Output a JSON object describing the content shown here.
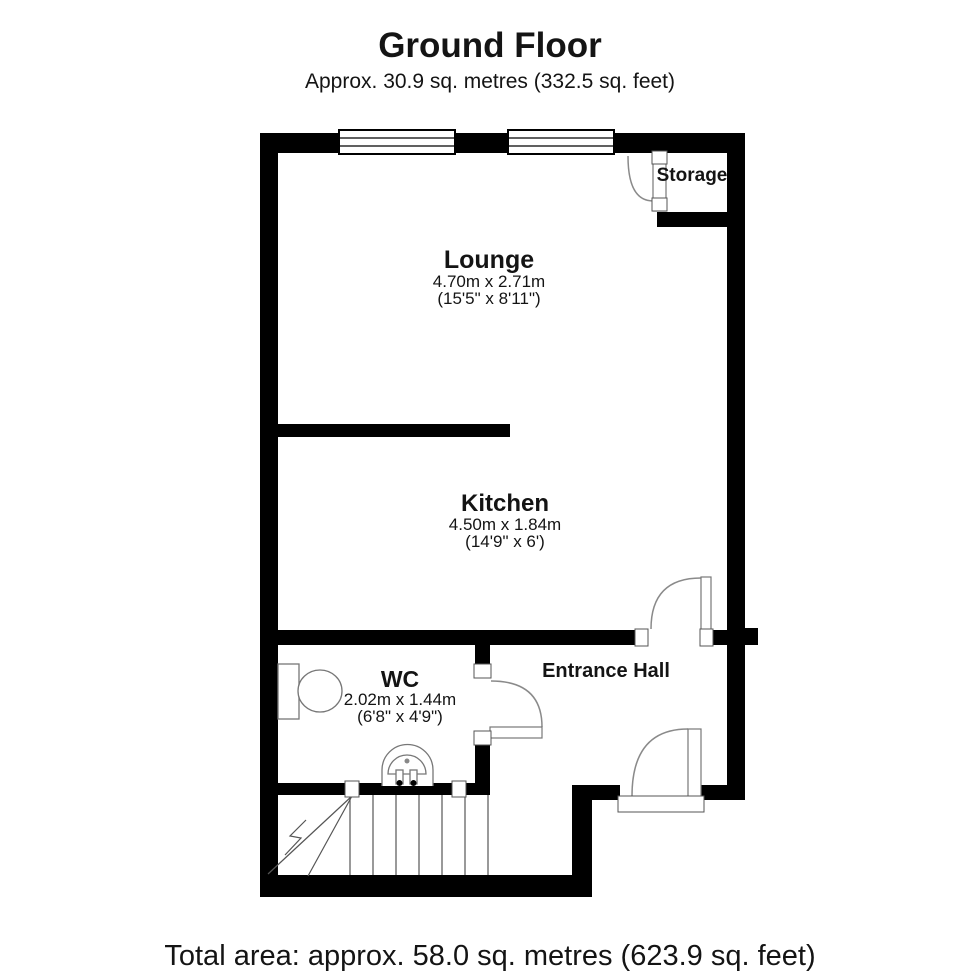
{
  "header": {
    "title": "Ground Floor",
    "subtitle": "Approx. 30.9 sq. metres (332.5 sq. feet)"
  },
  "footer": {
    "total_area": "Total area: approx. 58.0 sq. metres (623.9 sq. feet)"
  },
  "rooms": {
    "lounge": {
      "name": "Lounge",
      "dimensions_metric": "4.70m x 2.71m",
      "dimensions_imperial": "(15'5\" x 8'11\")"
    },
    "kitchen": {
      "name": "Kitchen",
      "dimensions_metric": "4.50m x 1.84m",
      "dimensions_imperial": "(14'9\" x 6')"
    },
    "wc": {
      "name": "WC",
      "dimensions_metric": "2.02m x 1.44m",
      "dimensions_imperial": "(6'8\" x 4'9\")"
    },
    "entrance_hall": {
      "name": "Entrance Hall"
    },
    "storage": {
      "name": "Storage"
    }
  },
  "colors": {
    "wall": "#000000",
    "background": "#ffffff",
    "fixture_line": "#777777",
    "door_arc": "#8a8a8a",
    "stair_line": "#555555"
  }
}
